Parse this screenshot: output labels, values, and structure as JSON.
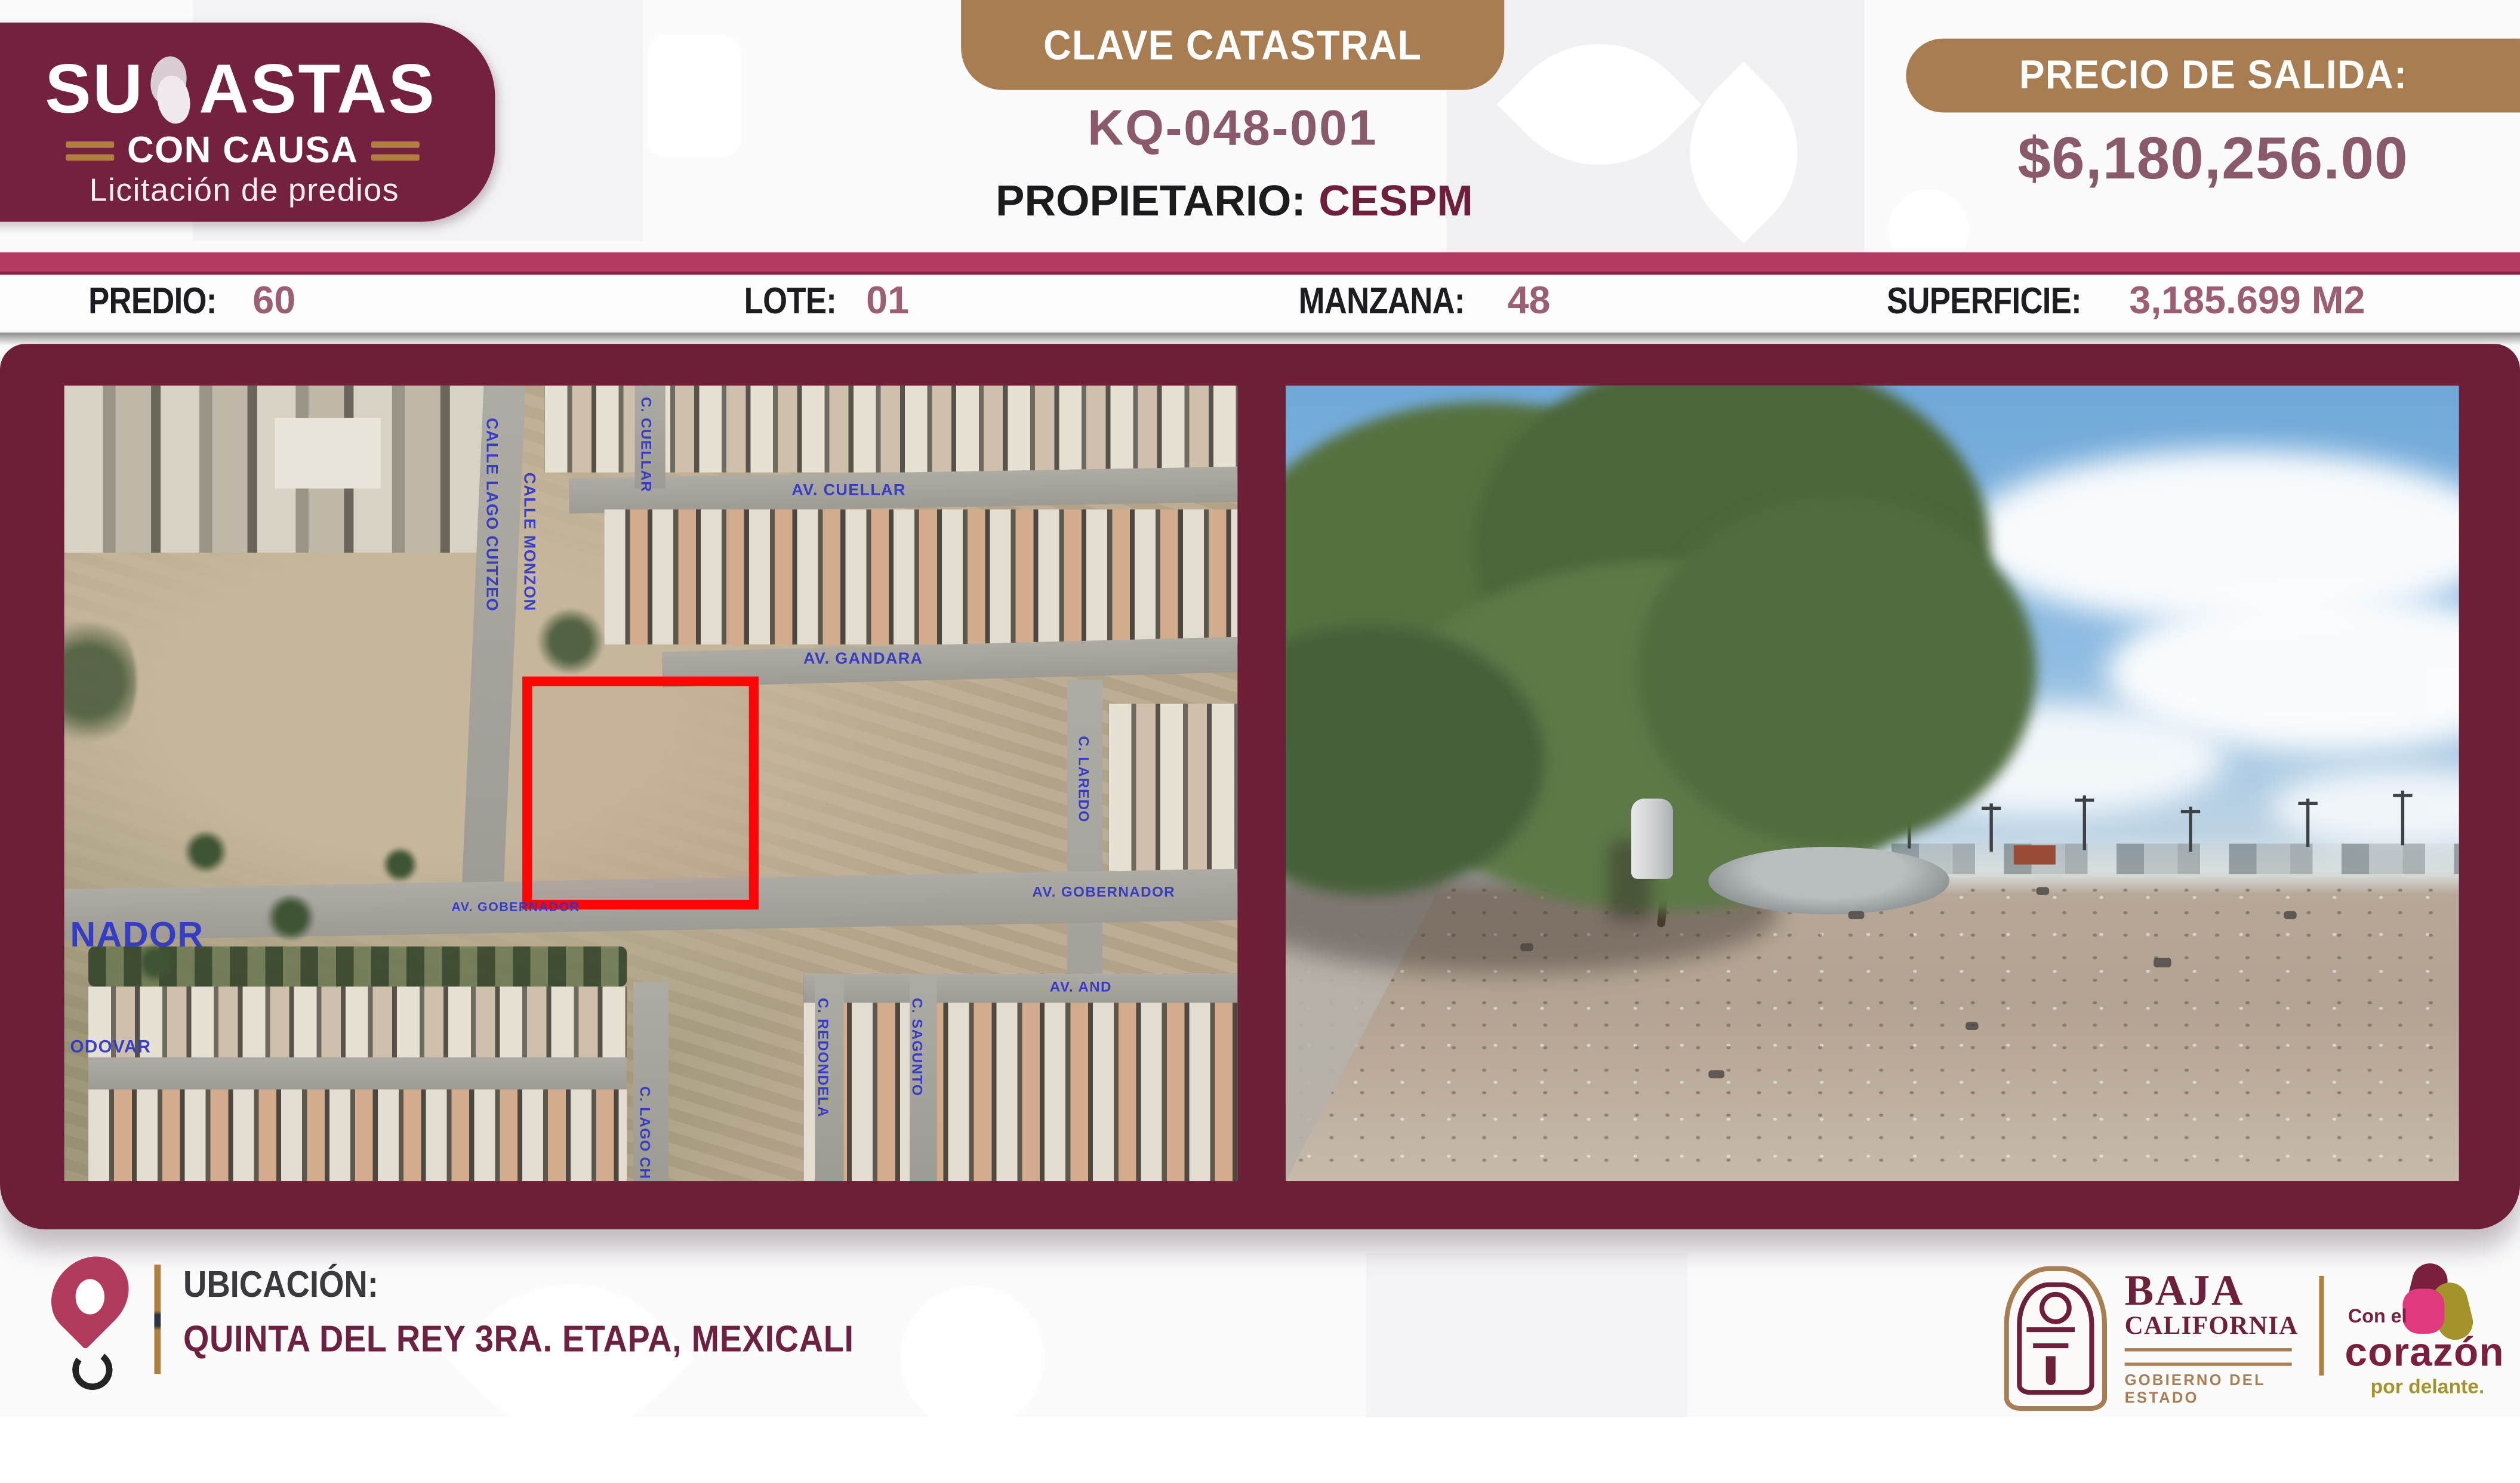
{
  "header": {
    "logo": {
      "title_prefix": "SU",
      "title_suffix": "ASTAS",
      "subtitle": "CON CAUSA",
      "tagline": "Licitación de predios"
    },
    "clave": {
      "label": "CLAVE CATASTRAL",
      "code": "KQ-048-001"
    },
    "propietario": {
      "label": "PROPIETARIO:",
      "value": "CESPM"
    },
    "price": {
      "label": "PRECIO DE SALIDA:",
      "amount": "$6,180,256.00"
    }
  },
  "info": {
    "predio": {
      "label": "PREDIO:",
      "value": "60"
    },
    "lote": {
      "label": "LOTE:",
      "value": "01"
    },
    "manzana": {
      "label": "MANZANA:",
      "value": "48"
    },
    "superficie": {
      "label": "SUPERFICIE:",
      "value": "3,185.699 M2"
    }
  },
  "map": {
    "labels": [
      {
        "text": "CALLE LAGO CUITZEO"
      },
      {
        "text": "CALLE MONZON"
      },
      {
        "text": "C. CUELLAR"
      },
      {
        "text": "AV. CUELLAR"
      },
      {
        "text": "AV. GANDARA"
      },
      {
        "text": "C. LAREDO"
      },
      {
        "text": "AV. GOBERNADOR"
      },
      {
        "text": "NADOR"
      },
      {
        "text": "ODOVAR"
      },
      {
        "text": "C. LAGO CH"
      },
      {
        "text": "C. REDONDELA"
      },
      {
        "text": "C. SAGUNTO"
      },
      {
        "text": "AV. AND"
      },
      {
        "text": "AV. GOBERNADOR"
      }
    ]
  },
  "footer": {
    "ubicacion_label": "UBICACIÓN:",
    "address": "QUINTA DEL REY 3RA. ETAPA, MEXICALI",
    "gobierno": {
      "line1": "BAJA",
      "line2": "CALIFORNIA",
      "line3": "GOBIERNO DEL ESTADO"
    },
    "corazon": {
      "line1": "Con el",
      "line2": "corazón",
      "line3": "por delante."
    }
  },
  "colors": {
    "maroon_panel": "#6D1F38",
    "logo_maroon": "#742140",
    "crimson_bar": "#B43A5F",
    "tan": "#A87D52",
    "mauve_value": "#8A5A6C",
    "parcel_red": "#FF0505",
    "street_blue": "#2D35C8"
  }
}
